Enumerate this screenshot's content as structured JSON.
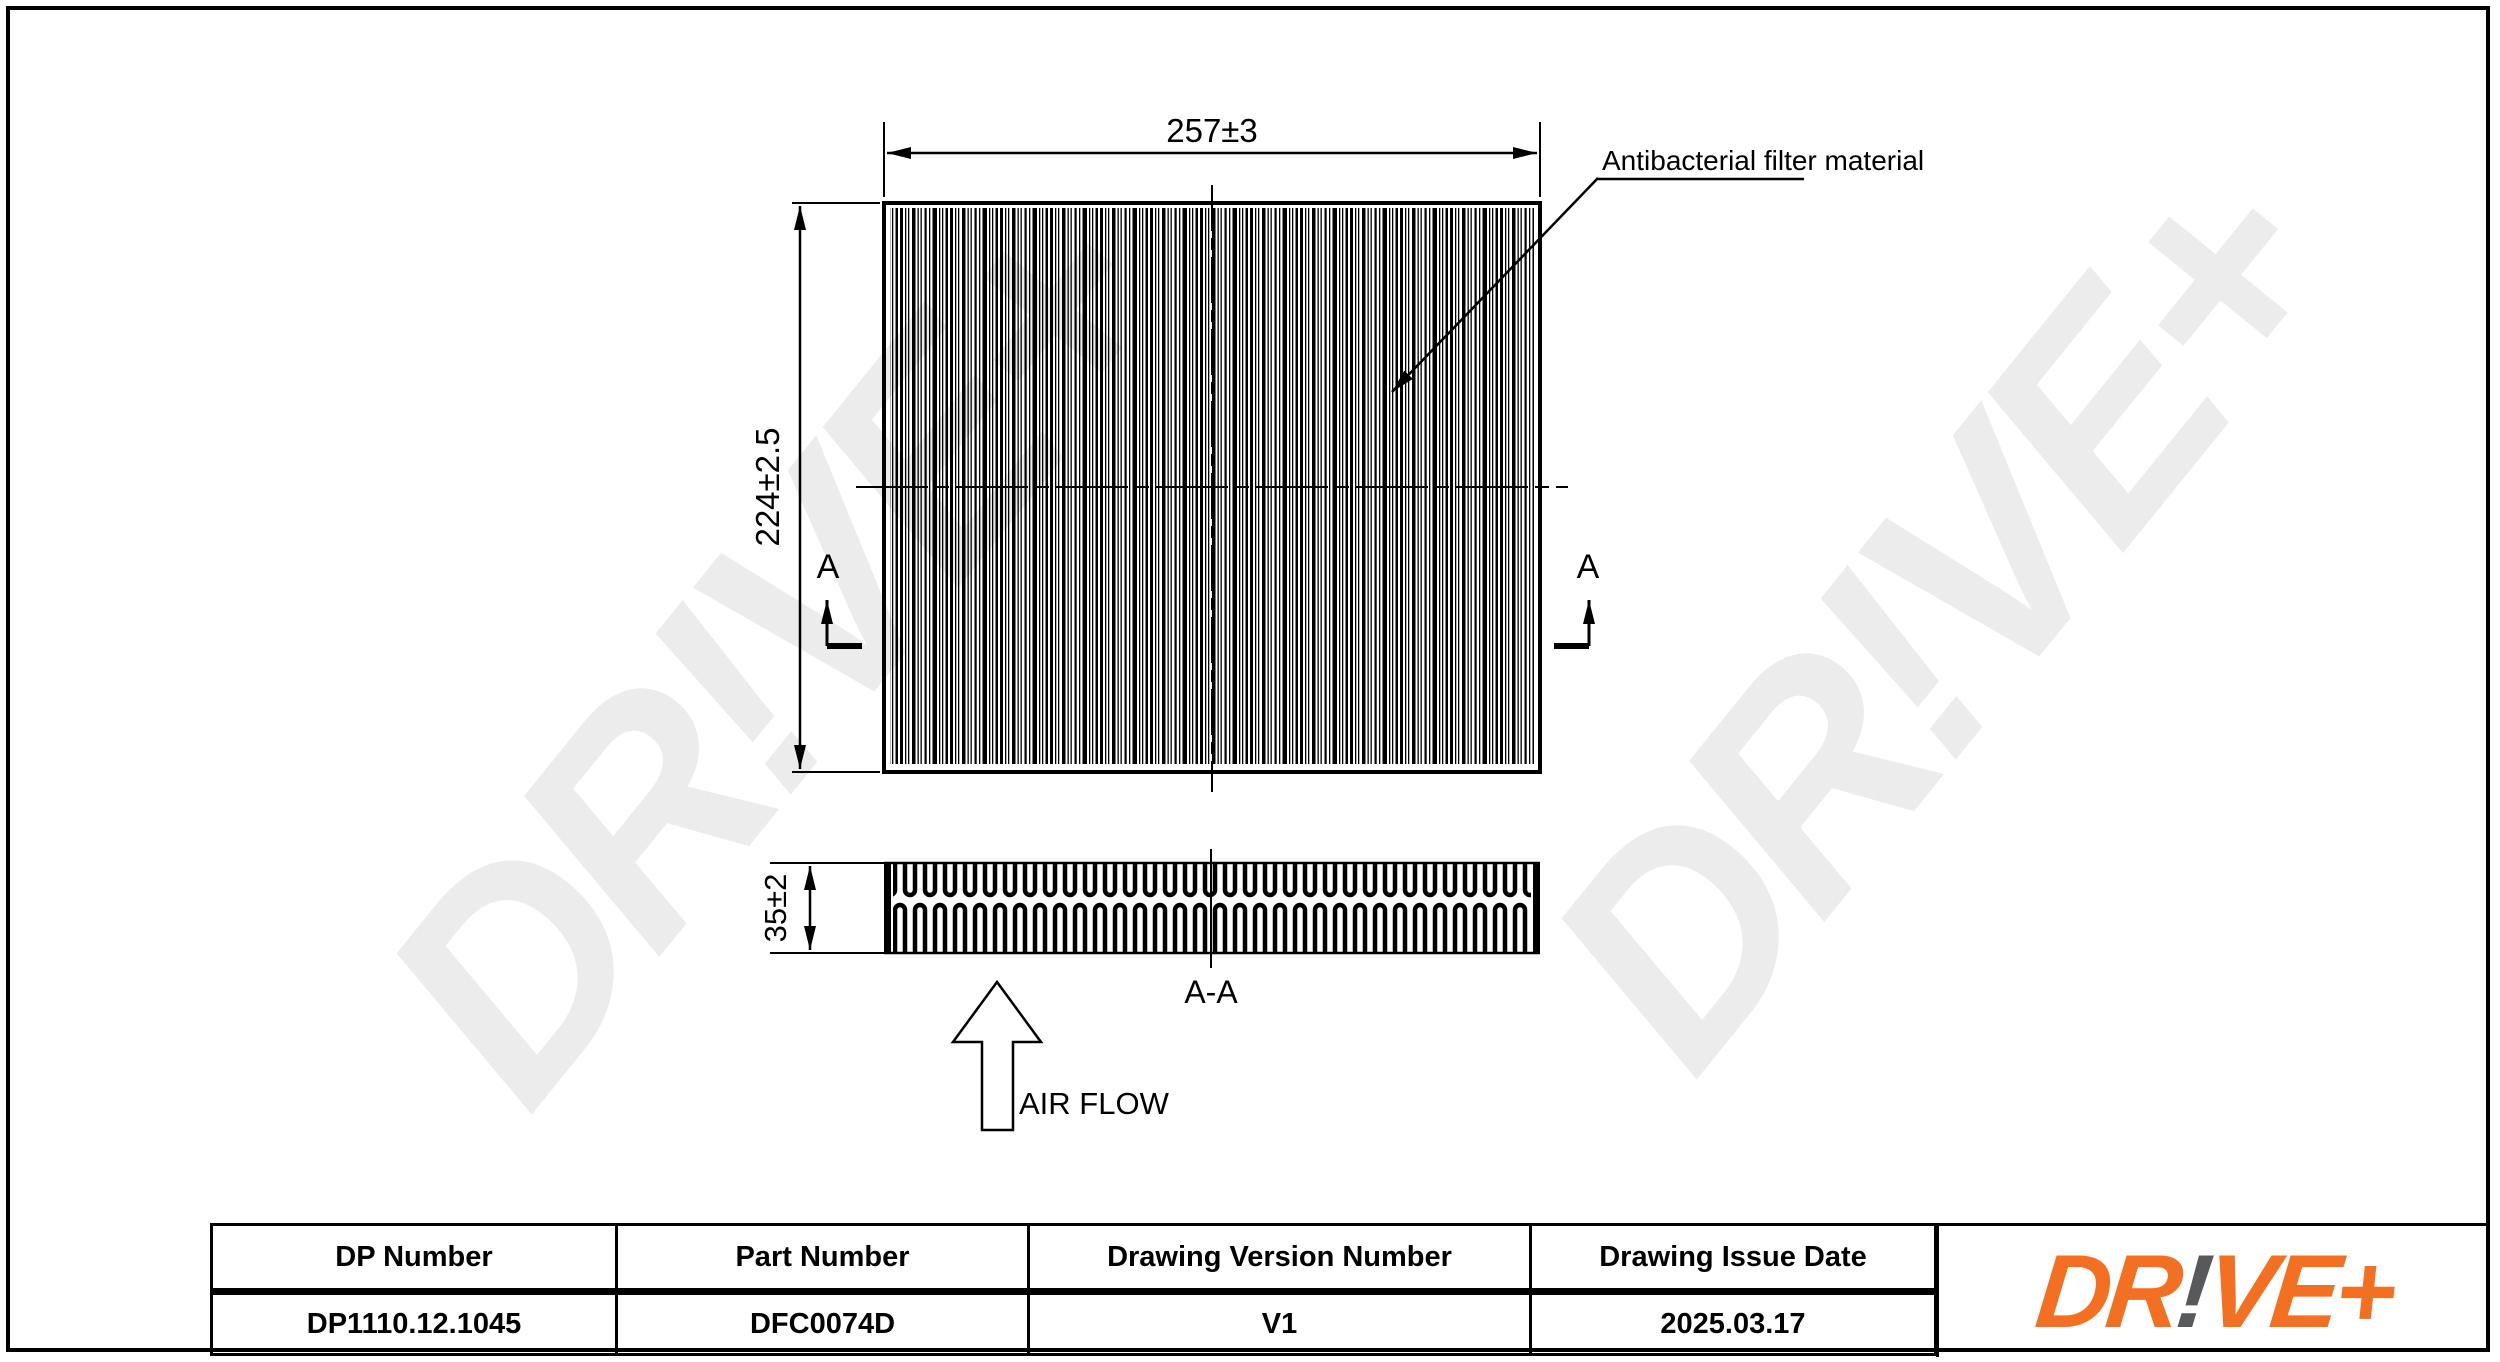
{
  "drawing": {
    "dim_width": "257±3",
    "dim_height": "224±2.5",
    "dim_depth": "35±2",
    "section_letter": "A",
    "section_label": "A-A",
    "airflow_label": "AIR FLOW",
    "material_label": "Antibacterial filter material"
  },
  "watermark": {
    "text": "DR!VE+"
  },
  "logo": {
    "part1": "DR",
    "bang": "!",
    "part2": "VE+"
  },
  "colors": {
    "line": "#000000",
    "watermark_gray": "#ececec",
    "logo_orange": "#F36F21",
    "logo_bang_gray": "#58595B"
  },
  "table": {
    "headers": [
      "DP Number",
      "Part Number",
      "Drawing Version Number",
      "Drawing Issue Date"
    ],
    "values": [
      "DP1110.12.1045",
      "DFC0074D",
      "V1",
      "2025.03.17"
    ]
  }
}
